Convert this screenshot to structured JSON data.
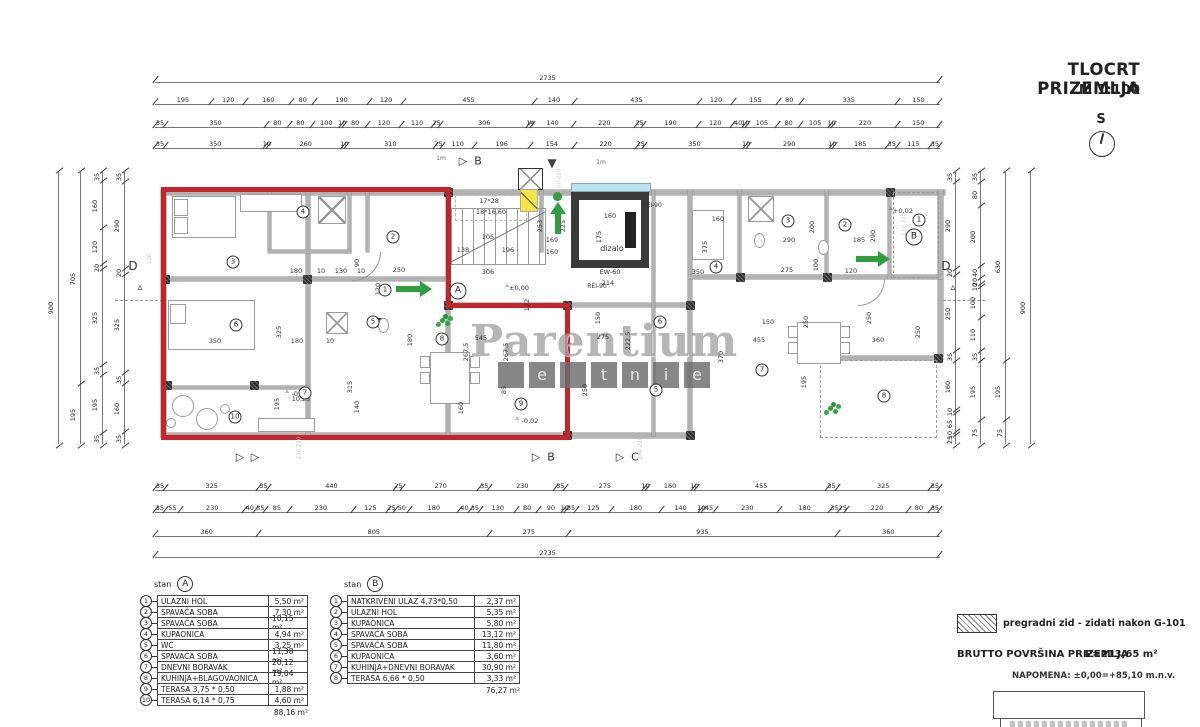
{
  "title": {
    "main": "TLOCRT PRIZEMLJA",
    "scale": "M 1:100",
    "north": "S"
  },
  "watermark": {
    "main": "Parentium",
    "sub": [
      "",
      "e",
      "",
      "t",
      "n",
      "i",
      "e"
    ]
  },
  "notes": {
    "hatch_label": "pregradni zid - zidati nakon G-101",
    "brutto_label": "BRUTTO POVRŠINA PRIZEMLJA",
    "brutto_value": "P=213,65 m²",
    "napomena": "NAPOMENA: ±0,00=+85,10 m.n.v."
  },
  "colors": {
    "outline_red": "#c4242b",
    "arrow_green": "#2f9e3f",
    "wall_gray": "#b2b2b2",
    "highlight_yellow": "#f4e447",
    "elevator_blue": "#bfe2f2"
  },
  "dims": {
    "top": [
      [
        2735
      ],
      [
        195,
        120,
        160,
        80,
        190,
        120,
        455,
        140,
        435,
        120,
        155,
        80,
        335,
        150
      ],
      [
        35,
        350,
        80,
        80,
        100,
        10,
        80,
        120,
        110,
        25,
        306,
        14,
        140,
        220,
        25,
        190,
        120,
        40,
        10,
        105,
        80,
        105,
        10,
        220,
        150
      ],
      [
        35,
        350,
        10,
        260,
        10,
        310,
        25,
        110,
        196,
        154,
        220,
        25,
        350,
        10,
        290,
        10,
        185,
        35,
        115,
        35
      ]
    ],
    "bottom": [
      [
        35,
        325,
        35,
        440,
        25,
        270,
        35,
        230,
        35,
        275,
        10,
        160,
        10,
        455,
        35,
        325,
        35
      ],
      [
        35,
        55,
        230,
        40,
        35,
        85,
        230,
        125,
        25,
        50,
        180,
        40,
        35,
        130,
        80,
        90,
        10,
        35,
        125,
        180,
        140,
        10,
        45,
        230,
        180,
        35,
        25,
        220,
        80,
        35
      ],
      [
        360,
        805,
        275,
        935,
        360
      ],
      [
        2735
      ]
    ],
    "left": [
      [
        900
      ],
      [
        705,
        195
      ],
      [
        35,
        160,
        120,
        20,
        325,
        35,
        195,
        35
      ],
      [
        35,
        290,
        20,
        325,
        35,
        160,
        35
      ]
    ],
    "right": [
      [
        35,
        290,
        20,
        250,
        35,
        160,
        10,
        65,
        10,
        25
      ],
      [
        35,
        80,
        200,
        40,
        20,
        10,
        100,
        110,
        35,
        195,
        75
      ],
      [
        630,
        195,
        75
      ],
      [
        900
      ]
    ]
  },
  "plan": {
    "rooms_a": [
      [
        "1",
        385,
        290
      ],
      [
        "2",
        393,
        237
      ],
      [
        "3",
        233,
        262
      ],
      [
        "4",
        303,
        212
      ],
      [
        "5",
        373,
        322
      ],
      [
        "6",
        236,
        325
      ],
      [
        "7",
        305,
        393
      ],
      [
        "8",
        442,
        339
      ],
      [
        "9",
        521,
        404
      ],
      [
        "10",
        235,
        417
      ]
    ],
    "rooms_b": [
      [
        "1",
        919,
        220
      ],
      [
        "2",
        845,
        225
      ],
      [
        "3",
        788,
        221
      ],
      [
        "4",
        716,
        267
      ],
      [
        "5",
        656,
        390
      ],
      [
        "6",
        660,
        322
      ],
      [
        "7",
        762,
        370
      ],
      [
        "8",
        884,
        396
      ]
    ],
    "units": [
      [
        "A",
        458,
        291
      ],
      [
        "B",
        914,
        237
      ]
    ],
    "labels": [
      [
        "105",
        488,
        237,
        0
      ],
      [
        "138",
        463,
        250,
        0
      ],
      [
        "196",
        508,
        250,
        0
      ],
      [
        "306",
        488,
        272,
        0
      ],
      [
        "169",
        552,
        240,
        0
      ],
      [
        "160",
        552,
        252,
        0
      ],
      [
        "253",
        540,
        226,
        1
      ],
      [
        "225",
        563,
        226,
        1
      ],
      [
        "17*28",
        489,
        201,
        0
      ],
      [
        "18*16,60",
        491,
        212,
        0
      ],
      [
        "160",
        610,
        216,
        0
      ],
      [
        "175",
        599,
        237,
        1
      ],
      [
        "dizalo",
        612,
        249,
        0,
        8
      ],
      [
        "EW-60",
        610,
        272,
        0
      ],
      [
        "214",
        608,
        283,
        0
      ],
      [
        "150",
        598,
        318,
        1
      ],
      [
        "122",
        527,
        305,
        1
      ],
      [
        "REI-90",
        652,
        206,
        0,
        6
      ],
      [
        "REI-90",
        597,
        287,
        0,
        6
      ],
      [
        "±0,00",
        519,
        288,
        0
      ],
      [
        "▵",
        507,
        285,
        0
      ],
      [
        "1m",
        441,
        159,
        0,
        6,
        "#666"
      ],
      [
        "1m",
        601,
        163,
        0,
        6,
        "#666"
      ],
      [
        "180",
        296,
        271,
        0
      ],
      [
        "10",
        321,
        271,
        0
      ],
      [
        "130",
        341,
        271,
        0
      ],
      [
        "10",
        361,
        271,
        0
      ],
      [
        "250",
        399,
        270,
        0
      ],
      [
        "120",
        378,
        289,
        1
      ],
      [
        "90",
        357,
        263,
        1
      ],
      [
        "350",
        215,
        341,
        0
      ],
      [
        "325",
        279,
        332,
        1
      ],
      [
        "180",
        297,
        341,
        0
      ],
      [
        "10",
        330,
        341,
        0
      ],
      [
        "180",
        410,
        340,
        1
      ],
      [
        "315",
        350,
        387,
        1
      ],
      [
        "195",
        277,
        404,
        1
      ],
      [
        "10,25",
        301,
        399,
        0
      ],
      [
        "140",
        357,
        407,
        1
      ],
      [
        "-0,02",
        300,
        394,
        0
      ],
      [
        "▵",
        287,
        391,
        0
      ],
      [
        "-0,02",
        530,
        421,
        0
      ],
      [
        "▵",
        517,
        418,
        0
      ],
      [
        "545",
        481,
        338,
        0
      ],
      [
        "267,5",
        466,
        352,
        1
      ],
      [
        "267,5",
        506,
        352,
        1
      ],
      [
        "85",
        504,
        390,
        1
      ],
      [
        "160",
        461,
        408,
        1
      ],
      [
        "275",
        603,
        337,
        0
      ],
      [
        "222,5",
        628,
        341,
        1
      ],
      [
        "250",
        585,
        390,
        1
      ],
      [
        "160",
        718,
        219,
        0
      ],
      [
        "375",
        705,
        247,
        1
      ],
      [
        "350",
        698,
        272,
        0
      ],
      [
        "290",
        789,
        240,
        0
      ],
      [
        "200",
        812,
        227,
        1
      ],
      [
        "275",
        787,
        270,
        0
      ],
      [
        "100",
        816,
        265,
        1
      ],
      [
        "120",
        851,
        271,
        0
      ],
      [
        "185",
        859,
        240,
        0
      ],
      [
        "290",
        873,
        236,
        1
      ],
      [
        "+0,02",
        903,
        211,
        0
      ],
      [
        "▵",
        891,
        208,
        0
      ],
      [
        "150",
        768,
        322,
        0
      ],
      [
        "455",
        759,
        340,
        0
      ],
      [
        "370",
        721,
        357,
        1
      ],
      [
        "250",
        806,
        322,
        1
      ],
      [
        "360",
        878,
        340,
        0
      ],
      [
        "250",
        869,
        318,
        1
      ],
      [
        "195",
        804,
        382,
        1
      ],
      [
        "250",
        918,
        332,
        1
      ],
      [
        "100 220",
        560,
        180,
        1,
        5.5,
        "#c9c9c9"
      ],
      [
        "230 220",
        300,
        448,
        1,
        5.5,
        "#bbb"
      ],
      [
        "180 220",
        641,
        448,
        1,
        5.5,
        "#bbb"
      ],
      [
        "120",
        150,
        259,
        1,
        6,
        "#ccc"
      ],
      [
        "110 220",
        905,
        224,
        1,
        5.5,
        "#c9c9c9"
      ],
      [
        "▷",
        463,
        161,
        0,
        11
      ],
      [
        "B",
        478,
        161,
        0,
        11
      ],
      [
        "▼",
        552,
        163,
        0,
        12,
        "#444"
      ],
      [
        "▷",
        240,
        457,
        0,
        11
      ],
      [
        "▷",
        255,
        457,
        0,
        11
      ],
      [
        "▷",
        536,
        457,
        0,
        11
      ],
      [
        "B",
        551,
        457,
        0,
        11
      ],
      [
        "▷",
        620,
        457,
        0,
        11
      ],
      [
        "C",
        635,
        457,
        0,
        11
      ],
      [
        "D",
        133,
        266,
        0,
        12
      ],
      [
        "▵",
        140,
        288,
        0,
        10
      ],
      [
        "D",
        946,
        266,
        0,
        12
      ],
      [
        "▵",
        953,
        288,
        0,
        10
      ]
    ]
  },
  "legend_a": {
    "header": "stan",
    "badge": "A",
    "rows": [
      {
        "n": "1",
        "name": "ULAZNI HOL",
        "area": "5,50 m²"
      },
      {
        "n": "2",
        "name": "SPAVAĆA SOBA",
        "area": "7,30 m²"
      },
      {
        "n": "3",
        "name": "SPAVAĆA SOBA",
        "area": "10,15 m²"
      },
      {
        "n": "4",
        "name": "KUPAONICA",
        "area": "4,94 m²"
      },
      {
        "n": "5",
        "name": "WC",
        "area": "3,25 m²"
      },
      {
        "n": "6",
        "name": "SPAVAĆA SOBA",
        "area": "11,38 m²"
      },
      {
        "n": "7",
        "name": "DNEVNI BORAVAK",
        "area": "20,12 m²"
      },
      {
        "n": "8",
        "name": "KUHINJA+BLAGOVAONICA",
        "area": "19,04 m²"
      },
      {
        "n": "9",
        "name": "TERASA 3,75 * 0,50",
        "area": "1,88 m²"
      },
      {
        "n": "10",
        "name": "TERASA 6,14 * 0,75",
        "area": "4,60 m²"
      }
    ],
    "total": "88,16 m²"
  },
  "legend_b": {
    "header": "stan",
    "badge": "B",
    "rows": [
      {
        "n": "1",
        "name": "NATKRIVENI ULAZ 4,73*0,50",
        "area": "2,37 m²"
      },
      {
        "n": "2",
        "name": "ULAZNI HOL",
        "area": "5,35 m²"
      },
      {
        "n": "3",
        "name": "KUPAONICA",
        "area": "5,80 m²"
      },
      {
        "n": "4",
        "name": "SPAVAĆA SOBA",
        "area": "13,12 m²"
      },
      {
        "n": "5",
        "name": "SPAVAĆA SOBA",
        "area": "11,80 m²"
      },
      {
        "n": "6",
        "name": "KUPAONICA",
        "area": "3,60 m²"
      },
      {
        "n": "7",
        "name": "KUHINJA+DNEVNI BORAVAK",
        "area": "30,90 m²"
      },
      {
        "n": "8",
        "name": "TERASA 6,66 * 0,50",
        "area": "3,33 m²"
      }
    ],
    "total": "76,27 m²"
  }
}
